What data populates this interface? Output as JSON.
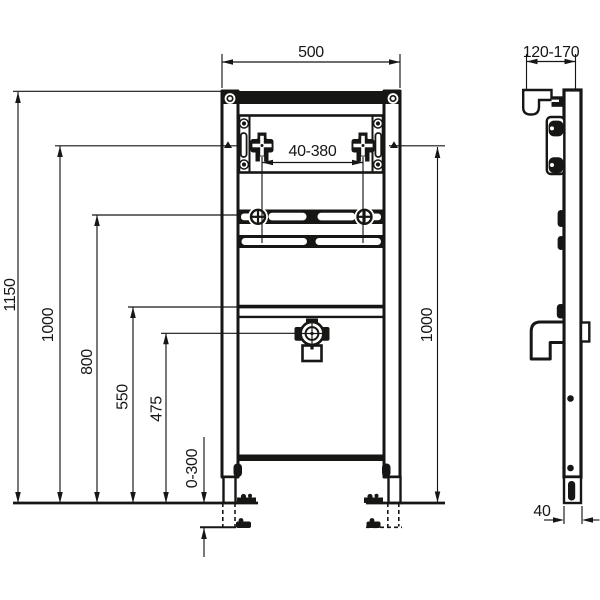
{
  "drawing": {
    "kind": "installation-frame-technical-drawing",
    "colors": {
      "line": "#161614",
      "background": "#ffffff"
    }
  },
  "dimensions_mm": {
    "frame_width": "500",
    "wall_distance": "120-170",
    "tap_fixing_range": "40-380",
    "total_height": "1150",
    "left_height": "1000",
    "bolt_height": "800",
    "rail_height": "550",
    "drain_height": "475",
    "foot_adjust_range": "0-300",
    "right_height": "1000",
    "profile_depth": "40"
  }
}
